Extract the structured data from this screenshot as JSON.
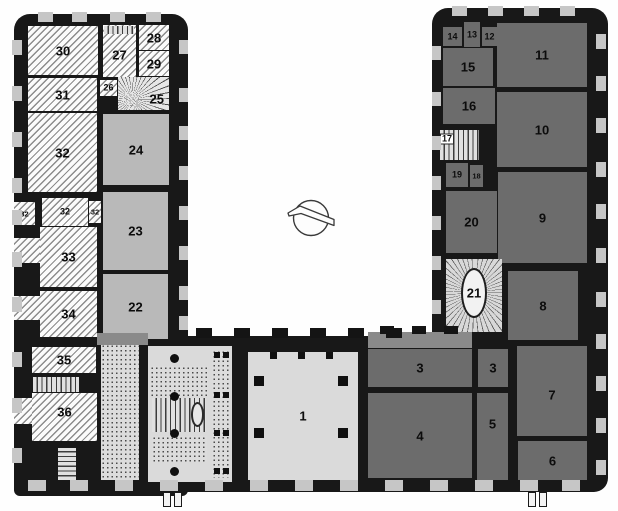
{
  "plan": {
    "type": "architectural-floor-plan-scan",
    "style": "U-shaped palace ground plan around a courtyard, north-arrow in courtyard",
    "palette": {
      "wall": "#181818",
      "dark_room": "#6c6c6c",
      "light_room": "#b9b9b9",
      "hall": "#dadada",
      "hatch_line": "#8c8c8c",
      "window_opening": "#c6c6c6",
      "background": "#fefefe"
    }
  },
  "compass": {
    "name": "north-arrow"
  },
  "rooms": [
    {
      "id": "r30",
      "label": "30",
      "x": 28,
      "y": 26,
      "w": 70,
      "h": 49,
      "fill": "hatched"
    },
    {
      "id": "r27",
      "label": "27",
      "x": 103,
      "y": 25,
      "w": 33,
      "h": 52,
      "fill": "hatched",
      "ly": 58
    },
    {
      "id": "r28",
      "label": "28",
      "x": 139,
      "y": 25,
      "w": 30,
      "h": 25,
      "fill": "hatched"
    },
    {
      "id": "r29",
      "label": "29",
      "x": 139,
      "y": 51,
      "w": 30,
      "h": 25,
      "fill": "hatched"
    },
    {
      "id": "r31",
      "label": "31",
      "x": 28,
      "y": 78,
      "w": 69,
      "h": 33,
      "fill": "hatched"
    },
    {
      "id": "r26",
      "label": "26",
      "x": 100,
      "y": 80,
      "w": 17,
      "h": 16,
      "fill": "hatched",
      "cls": "sm"
    },
    {
      "id": "r25",
      "label": "25",
      "x": 118,
      "y": 77,
      "w": 51,
      "h": 33,
      "fill": "fan",
      "lx": 76,
      "ly": 66,
      "cls": "chipless"
    },
    {
      "id": "r32",
      "label": "32",
      "x": 28,
      "y": 113,
      "w": 69,
      "h": 79,
      "fill": "hatched"
    },
    {
      "id": "r24",
      "label": "24",
      "x": 103,
      "y": 114,
      "w": 66,
      "h": 71,
      "fill": "light"
    },
    {
      "id": "r32a",
      "label": "32",
      "x": 14,
      "y": 202,
      "w": 21,
      "h": 23,
      "fill": "hatched",
      "cls": "xs"
    },
    {
      "id": "r32b",
      "label": "32",
      "x": 42,
      "y": 198,
      "w": 46,
      "h": 28,
      "fill": "hatched",
      "cls": "sm"
    },
    {
      "id": "r32c",
      "label": "32",
      "x": 89,
      "y": 201,
      "w": 12,
      "h": 22,
      "fill": "hatched",
      "cls": "xs"
    },
    {
      "id": "r33",
      "label": "33",
      "x": 40,
      "y": 227,
      "w": 57,
      "h": 60,
      "fill": "hatched"
    },
    {
      "id": "r23",
      "label": "23",
      "x": 103,
      "y": 192,
      "w": 65,
      "h": 78,
      "fill": "light"
    },
    {
      "id": "r34",
      "label": "34",
      "x": 40,
      "y": 291,
      "w": 57,
      "h": 46,
      "fill": "hatched"
    },
    {
      "id": "r22",
      "label": "22",
      "x": 103,
      "y": 274,
      "w": 65,
      "h": 65,
      "fill": "light"
    },
    {
      "id": "r35",
      "label": "35",
      "x": 32,
      "y": 347,
      "w": 64,
      "h": 26,
      "fill": "hatched"
    },
    {
      "id": "r36",
      "label": "36",
      "x": 32,
      "y": 393,
      "w": 65,
      "h": 48,
      "fill": "hatched",
      "ly": 40
    },
    {
      "id": "r2",
      "label": "2",
      "x": 148,
      "y": 346,
      "w": 84,
      "h": 136,
      "fill": "hall",
      "lx": 84,
      "ly": 49
    },
    {
      "id": "r1",
      "label": "1",
      "x": 248,
      "y": 352,
      "w": 110,
      "h": 128,
      "fill": "hall"
    },
    {
      "id": "r3a",
      "label": "3",
      "x": 368,
      "y": 349,
      "w": 104,
      "h": 38,
      "fill": "dark"
    },
    {
      "id": "r3b",
      "label": "3",
      "x": 478,
      "y": 349,
      "w": 30,
      "h": 38,
      "fill": "dark"
    },
    {
      "id": "r4",
      "label": "4",
      "x": 368,
      "y": 393,
      "w": 104,
      "h": 85,
      "fill": "dark"
    },
    {
      "id": "r5",
      "label": "5",
      "x": 477,
      "y": 393,
      "w": 31,
      "h": 87,
      "fill": "dark",
      "ly": 36
    },
    {
      "id": "r7",
      "label": "7",
      "x": 517,
      "y": 346,
      "w": 70,
      "h": 90,
      "fill": "dark",
      "ly": 54
    },
    {
      "id": "r6",
      "label": "6",
      "x": 518,
      "y": 441,
      "w": 69,
      "h": 39,
      "fill": "dark"
    },
    {
      "id": "r14",
      "label": "14",
      "x": 443,
      "y": 27,
      "w": 19,
      "h": 19,
      "fill": "dark",
      "cls": "sm"
    },
    {
      "id": "r13",
      "label": "13",
      "x": 464,
      "y": 22,
      "w": 16,
      "h": 25,
      "fill": "dark",
      "cls": "sm"
    },
    {
      "id": "r12",
      "label": "12",
      "x": 482,
      "y": 27,
      "w": 15,
      "h": 19,
      "fill": "dark",
      "cls": "sm"
    },
    {
      "id": "r15",
      "label": "15",
      "x": 443,
      "y": 48,
      "w": 50,
      "h": 38,
      "fill": "dark"
    },
    {
      "id": "r11",
      "label": "11",
      "x": 497,
      "y": 23,
      "w": 90,
      "h": 64,
      "fill": "dark"
    },
    {
      "id": "r16",
      "label": "16",
      "x": 443,
      "y": 88,
      "w": 52,
      "h": 36,
      "fill": "dark"
    },
    {
      "id": "r10",
      "label": "10",
      "x": 497,
      "y": 92,
      "w": 90,
      "h": 75,
      "fill": "dark"
    },
    {
      "id": "r17",
      "label": "17",
      "x": 440,
      "y": 130,
      "w": 39,
      "h": 30,
      "fill": "treads-v",
      "cls": "chip",
      "lx": 18,
      "ly": 30
    },
    {
      "id": "r19",
      "label": "19",
      "x": 446,
      "y": 163,
      "w": 22,
      "h": 24,
      "fill": "dark",
      "cls": "sm"
    },
    {
      "id": "r18",
      "label": "18",
      "x": 470,
      "y": 165,
      "w": 13,
      "h": 22,
      "fill": "dark",
      "cls": "xs"
    },
    {
      "id": "r20",
      "label": "20",
      "x": 446,
      "y": 191,
      "w": 51,
      "h": 62,
      "fill": "dark"
    },
    {
      "id": "r9",
      "label": "9",
      "x": 498,
      "y": 172,
      "w": 89,
      "h": 91,
      "fill": "dark"
    },
    {
      "id": "r21",
      "label": "21",
      "x": 446,
      "y": 259,
      "w": 56,
      "h": 73,
      "fill": "ovalstair",
      "oval": true
    },
    {
      "id": "r8",
      "label": "8",
      "x": 508,
      "y": 271,
      "w": 70,
      "h": 69,
      "fill": "dark"
    }
  ],
  "features": [
    {
      "id": "stair-top-27",
      "kind": "straight-stair",
      "x": 104,
      "y": 26,
      "w": 30,
      "h": 8,
      "fill": "treads-v"
    },
    {
      "id": "stair-35-36",
      "kind": "straight-stair",
      "x": 33,
      "y": 377,
      "w": 46,
      "h": 15,
      "fill": "treads-v"
    },
    {
      "id": "stair-sw",
      "kind": "winder-stair",
      "x": 58,
      "y": 448,
      "w": 18,
      "h": 32,
      "fill": "treads-h"
    },
    {
      "id": "corridor-left",
      "kind": "corridor",
      "x": 101,
      "y": 344,
      "w": 38,
      "h": 136,
      "fill": "dots"
    },
    {
      "id": "landing-top",
      "kind": "landing",
      "x": 150,
      "y": 366,
      "w": 58,
      "h": 30,
      "fill": "dots"
    },
    {
      "id": "stair-main",
      "kind": "grand-stair",
      "x": 152,
      "y": 398,
      "w": 54,
      "h": 34,
      "fill": "treads-v",
      "newel": true
    },
    {
      "id": "landing-bottom",
      "kind": "landing",
      "x": 152,
      "y": 436,
      "w": 55,
      "h": 26,
      "fill": "dots"
    },
    {
      "id": "corridor-2",
      "kind": "corridor",
      "x": 212,
      "y": 350,
      "w": 18,
      "h": 128,
      "fill": "dots"
    },
    {
      "id": "bay-west-1",
      "kind": "window-bay",
      "x": 14,
      "y": 238,
      "w": 26,
      "h": 25,
      "fill": "hatched"
    },
    {
      "id": "bay-west-2",
      "kind": "window-bay",
      "x": 14,
      "y": 296,
      "w": 26,
      "h": 24,
      "fill": "hatched"
    },
    {
      "id": "bay-west-3",
      "kind": "window-bay",
      "x": 14,
      "y": 398,
      "w": 18,
      "h": 26,
      "fill": "hatched"
    },
    {
      "id": "junction-left",
      "kind": "wall-fill",
      "x": 97,
      "y": 333,
      "w": 51,
      "h": 12,
      "fill": "mid"
    },
    {
      "id": "junction-right",
      "kind": "wall-fill",
      "x": 368,
      "y": 332,
      "w": 104,
      "h": 16,
      "fill": "mid"
    }
  ]
}
